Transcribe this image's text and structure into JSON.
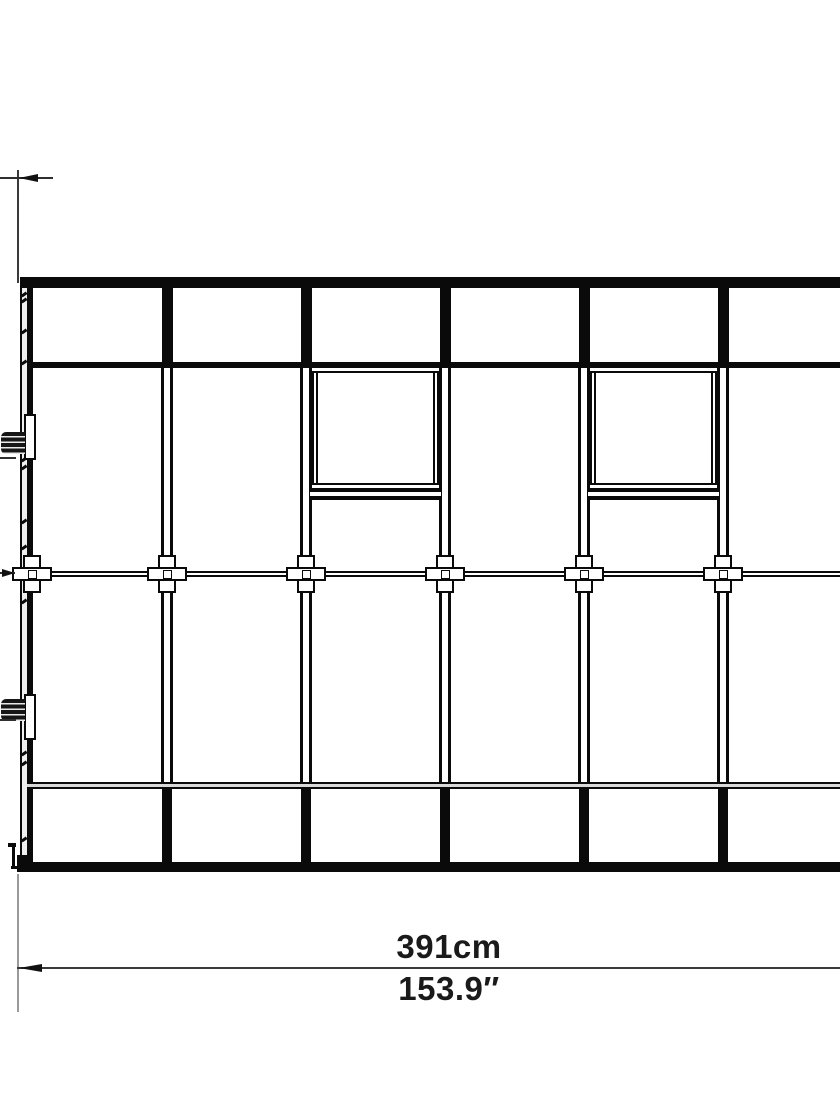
{
  "dimensions": {
    "width_cm": "391cm",
    "width_in": "153.9″"
  },
  "diagram": {
    "colors": {
      "ink": "#0a0a0a",
      "dim_line": "#2f2f2f",
      "ext_light": "#9a9a9a",
      "ext_dark": "#3a3a3a",
      "panel_fill": "#efefef",
      "rail_fill": "#d9d9d9",
      "white": "#ffffff"
    },
    "frame": {
      "left_post": {
        "outer_x": 20,
        "outer_w": 2,
        "fill_x": 22,
        "fill_w": 5,
        "bar_x": 27,
        "bar_w": 6,
        "top": 277,
        "bottom": 872
      },
      "top_rail": {
        "x": 20,
        "y": 277,
        "w": 820,
        "h": 11
      },
      "upper_rail": {
        "x": 27,
        "y": 362,
        "w": 813,
        "h": 6
      },
      "mid_rail": {
        "x": 30,
        "y": 571,
        "w": 810,
        "h": 6
      },
      "lower_rail": {
        "x": 27,
        "y": 782,
        "w": 813,
        "h": 7
      },
      "base_rail": {
        "x": 18,
        "y": 862,
        "w": 822,
        "h": 10
      }
    },
    "posts": {
      "centers": [
        167,
        306,
        445,
        584,
        723
      ],
      "top": {
        "y": 277,
        "h": 91,
        "w": 11
      },
      "mid": {
        "y": 368,
        "h": 414,
        "line_w": 3,
        "span": 12
      },
      "bottom": {
        "y": 789,
        "h": 73,
        "w": 10
      }
    },
    "windows": {
      "bays": [
        {
          "x1": 312,
          "x2": 439
        },
        {
          "x1": 590,
          "x2": 717
        }
      ],
      "y1": 371,
      "y2": 485,
      "inner_inset": 4,
      "sill_y": 488,
      "sill_h": 12
    },
    "connectors": {
      "xs": [
        32,
        167,
        306,
        445,
        584,
        723
      ],
      "cy": 574,
      "vbar_w": 18,
      "vbar_h": 38,
      "hbar_w": 40,
      "hbar_h": 14,
      "core": 9
    },
    "handles": [
      {
        "y": 414,
        "knob_dy": 18,
        "leader_dy": 43
      },
      {
        "y": 694,
        "knob_dy": 5,
        "leader_dy": 25
      }
    ],
    "foot_parts": [
      [
        12,
        845,
        2.5,
        23
      ],
      [
        8,
        843,
        8,
        4
      ],
      [
        11,
        866,
        15,
        3
      ],
      [
        17,
        855,
        16,
        17
      ]
    ],
    "ticks": [
      293,
      299,
      330,
      361,
      458,
      466,
      520,
      546,
      600,
      752,
      762,
      838
    ],
    "dims": {
      "top": {
        "ext_x": 17,
        "ext_y1": 170,
        "ext_y2": 283,
        "line_y": 177,
        "line_x": 0,
        "line_w": 53,
        "arrow_len": 19,
        "arrow_h": 9
      },
      "mid": {
        "line_y": 572,
        "line_w": 15,
        "arrow_len": 13,
        "arrow_h": 8
      },
      "bottom": {
        "ext_x": 17,
        "ext_y1": 874,
        "ext_y2": 1012,
        "line_y": 967,
        "line_x": 17,
        "line_w": 823,
        "arrow_len": 23,
        "arrow_h": 9
      }
    }
  }
}
